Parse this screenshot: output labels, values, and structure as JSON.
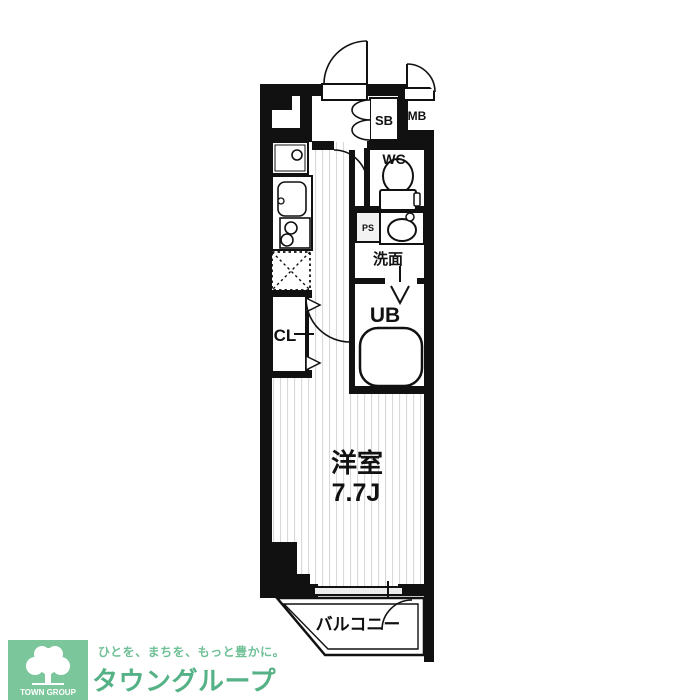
{
  "floorplan": {
    "labels": {
      "room": "洋室",
      "room_size": "7.7J",
      "closet": "CL",
      "bath": "UB",
      "toilet": "WC",
      "washroom": "洗面",
      "shoebox": "SB",
      "meterbox": "MB",
      "pipespace": "PS",
      "balcony": "バルコニー"
    }
  },
  "branding": {
    "logo_caption": "TOWN GROUP",
    "tagline": "ひとを、まちを、もっと豊かに。",
    "company_name": "タウングループ",
    "colors": {
      "logo_green": "#7cc69b",
      "brand_green": "#55b287",
      "wall_black": "#111111",
      "stripe_gray": "#d9d9d9"
    }
  }
}
